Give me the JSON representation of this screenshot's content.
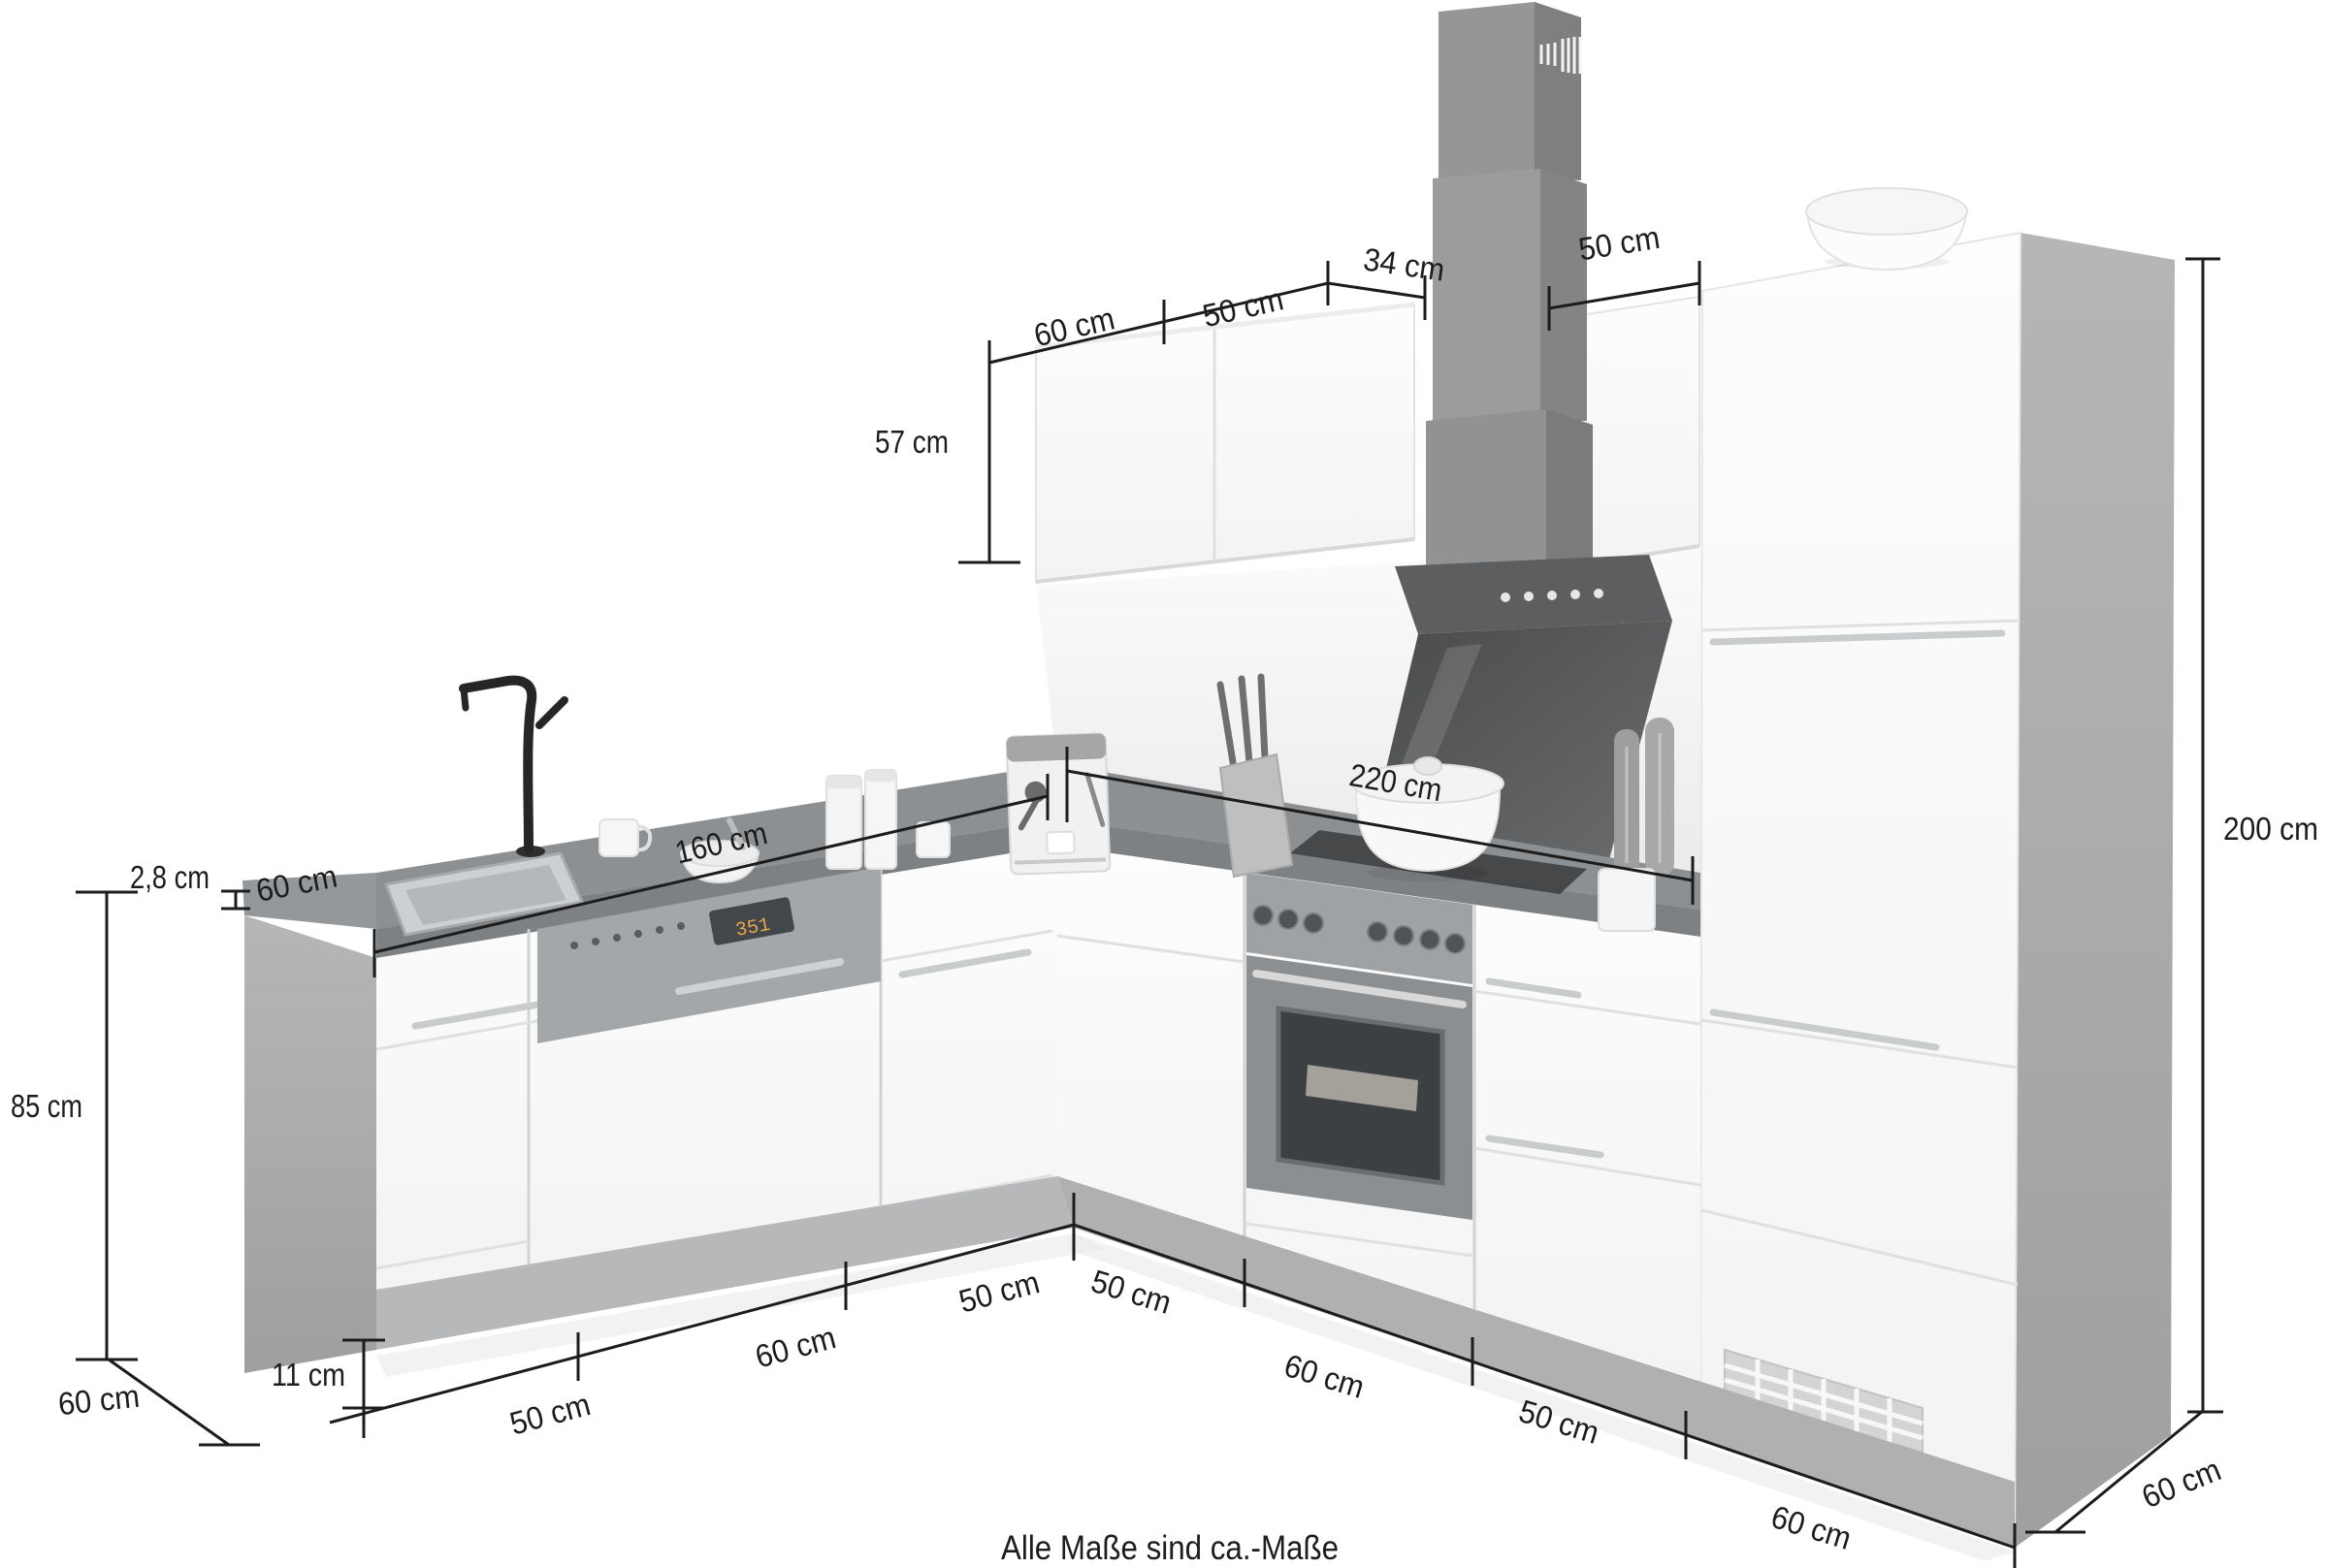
{
  "diagram": {
    "title": "L-shaped kitchen dimension drawing",
    "note": "Alle Maße sind ca.-Maße",
    "dishwasher_display": "351",
    "dimensions": {
      "top_wall_cabinet_left": "60 cm",
      "top_wall_cabinet_mid": "50 cm",
      "hood_gap": "34 cm",
      "top_wall_cabinet_right": "50 cm",
      "wall_cabinet_height": "57 cm",
      "tall_unit_height": "200 cm",
      "right_run_length": "220 cm",
      "left_run_length": "160 cm",
      "worktop_thickness": "2,8 cm",
      "worktop_depth": "60 cm",
      "base_height": "85 cm",
      "plinth_height": "11 cm",
      "left_seg_corner_50": "50 cm",
      "left_seg_mid_60": "60 cm",
      "left_seg_end_50": "50 cm",
      "left_depth": "60 cm",
      "right_seg_corner_50": "50 cm",
      "right_seg_mid_60": "60 cm",
      "right_seg_mid_50": "50 cm",
      "right_seg_end_60": "60 cm",
      "right_depth": "60 cm"
    },
    "colors": {
      "dimension_ink": "#1c1c1c",
      "worktop_grey": "#8d9092",
      "plinth_grey": "#b2b4b5",
      "side_panel_grey": "#aaacae",
      "hood_grey": "#5c5e60",
      "front_white": "#fbfbfb"
    }
  }
}
